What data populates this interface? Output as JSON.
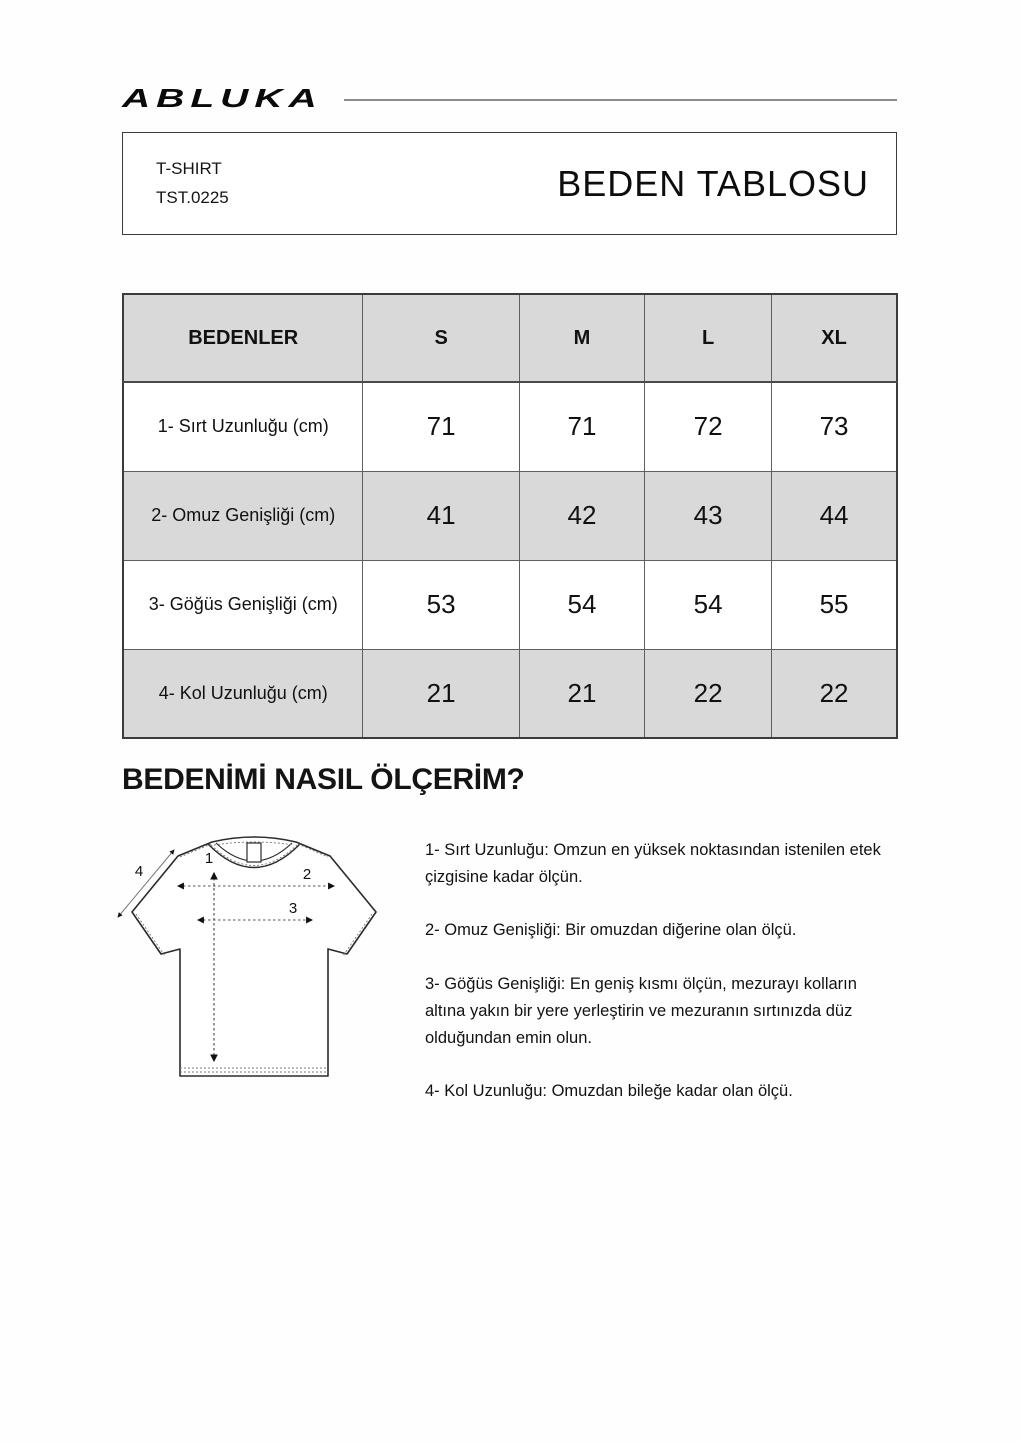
{
  "brand": {
    "logo_text": "ABLUKA"
  },
  "header": {
    "product_name": "T-SHIRT",
    "product_code": "TST.0225",
    "title": "BEDEN TABLOSU"
  },
  "size_table": {
    "columns": [
      "BEDENLER",
      "S",
      "M",
      "L",
      "XL"
    ],
    "rows": [
      {
        "label": "1- Sırt Uzunluğu (cm)",
        "values": [
          "71",
          "71",
          "72",
          "73"
        ]
      },
      {
        "label": "2- Omuz Genişliği (cm)",
        "values": [
          "41",
          "42",
          "43",
          "44"
        ]
      },
      {
        "label": "3- Göğüs Genişliği (cm)",
        "values": [
          "53",
          "54",
          "54",
          "55"
        ]
      },
      {
        "label": "4- Kol Uzunluğu (cm)",
        "values": [
          "21",
          "21",
          "22",
          "22"
        ]
      }
    ]
  },
  "how_to_measure": {
    "heading": "BEDENİMİ NASIL ÖLÇERİM?",
    "diagram_labels": [
      "1",
      "2",
      "3",
      "4"
    ],
    "instructions": [
      "1- Sırt Uzunluğu: Omzun en yüksek noktasından istenilen etek çizgisine kadar ölçün.",
      "2- Omuz Genişliği: Bir omuzdan diğerine olan ölçü.",
      "3- Göğüs Genişliği: En geniş kısmı ölçün, mezurayı kolların altına yakın bir yere yerleştirin ve mezuranın sırtınızda düz olduğundan emin olun.",
      "4- Kol Uzunluğu: Omuzdan bileğe kadar olan ölçü."
    ]
  },
  "colors": {
    "table_header_bg": "#d9d9d9",
    "table_alt_row_bg": "#d9d9d9",
    "table_border": "#4a4a4a",
    "rule": "#8c8c8c",
    "text": "#111111"
  }
}
